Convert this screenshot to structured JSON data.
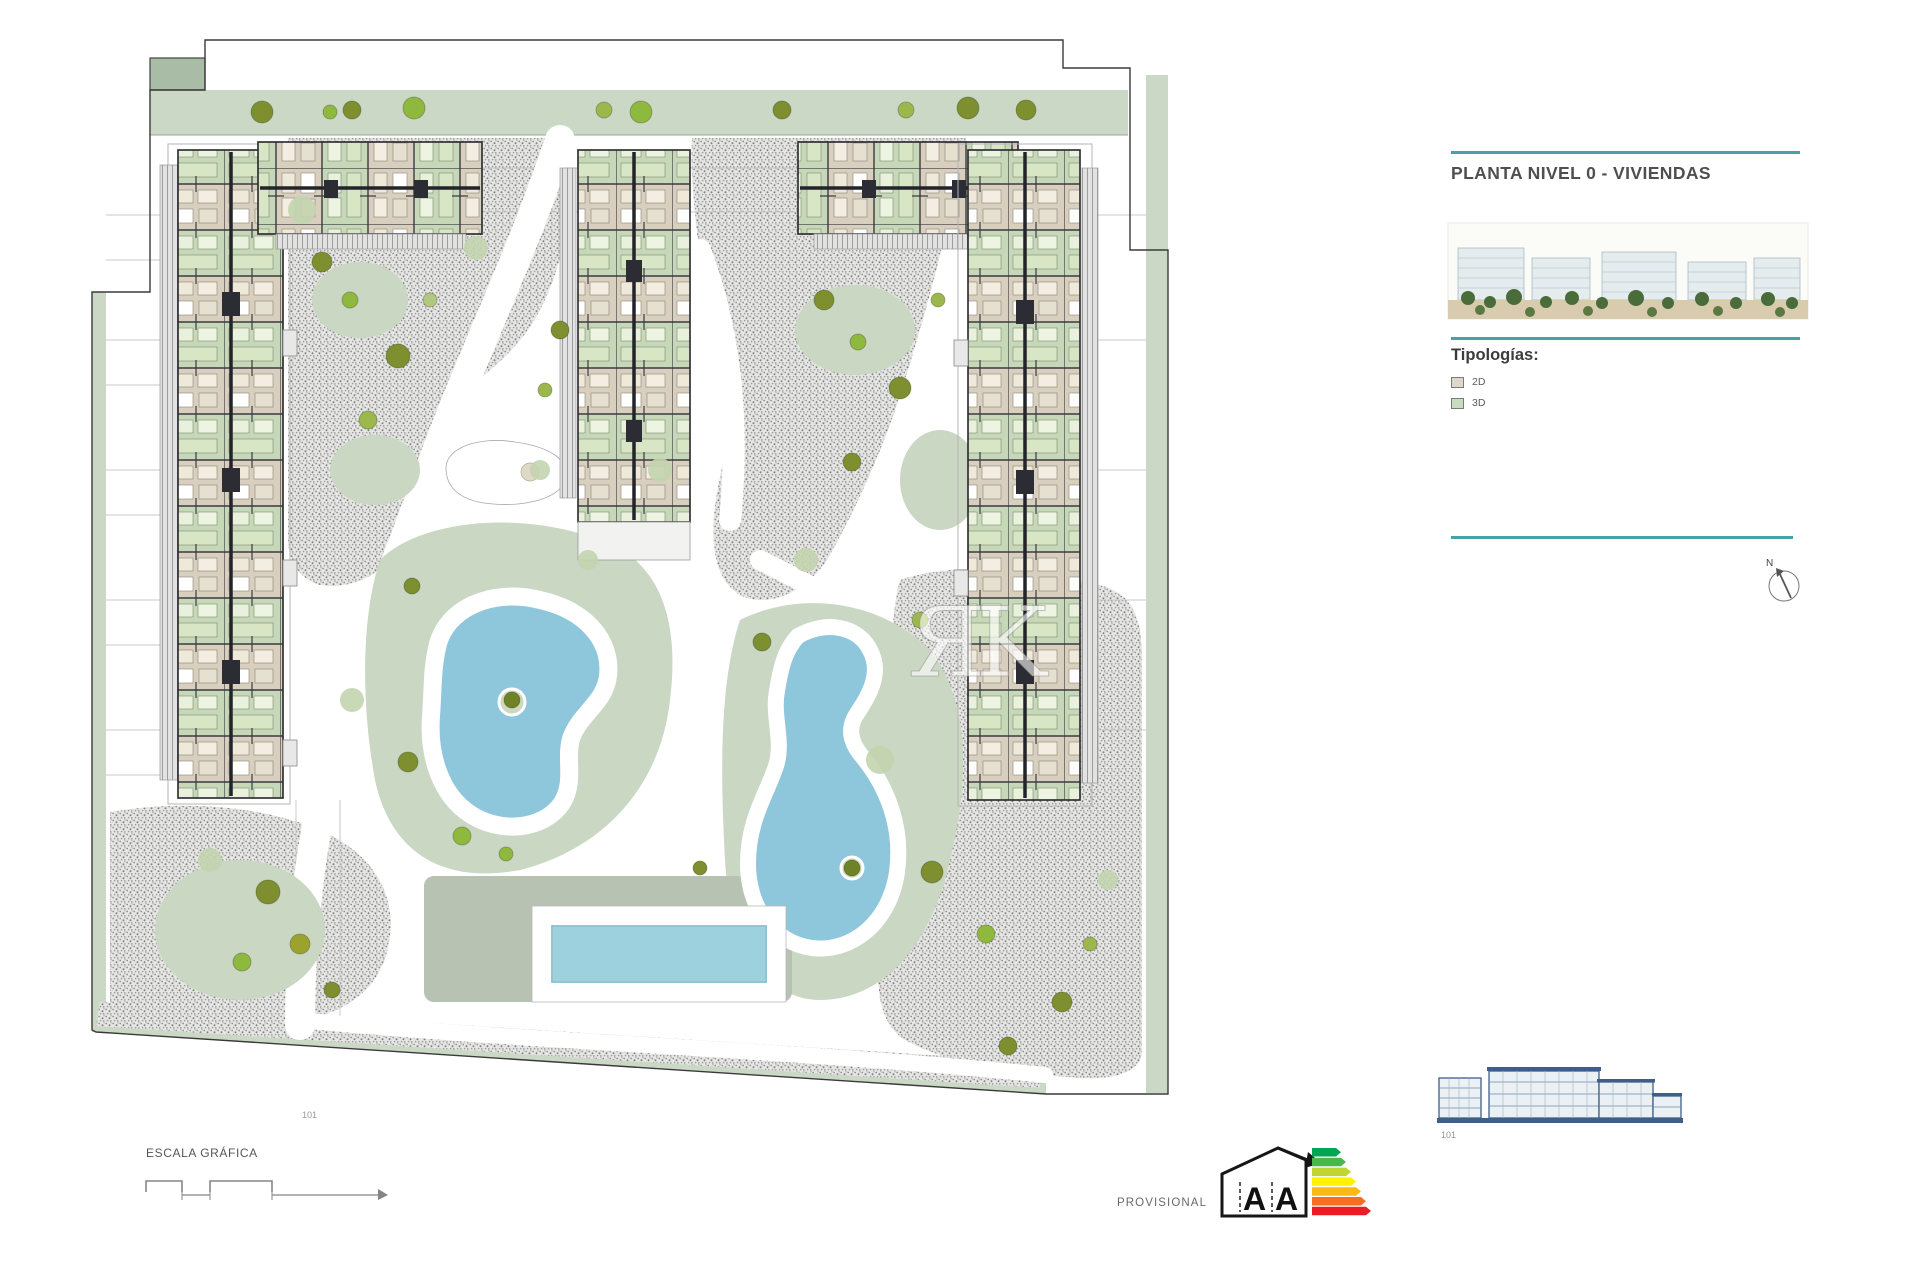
{
  "panel": {
    "accent_color": "#49a1a8",
    "title": "PLANTA NIVEL 0 - VIVIENDAS",
    "typologies_heading": "Tipologías:",
    "legend": [
      {
        "label": "2D",
        "color": "#ded7c9"
      },
      {
        "label": "3D",
        "color": "#c9dcc0"
      }
    ],
    "compass_label": "N"
  },
  "plan": {
    "watermark": "ЯK",
    "site_ref_label": "101",
    "colors": {
      "landscape_green": "#cbd8c5",
      "gravel_grey": "#a9a9a9",
      "pool_blue": "#8ec6dc",
      "unit_tan": "#d8cfbe",
      "unit_green": "#c7d8b8"
    }
  },
  "elevation": {
    "ref_label": "101"
  },
  "footer": {
    "scale_label": "ESCALA GRÁFICA",
    "provisional_label": "PROVISIONAL",
    "energy": {
      "letters": [
        "A",
        "A"
      ],
      "colors": [
        "#00a650",
        "#4cb748",
        "#bed62f",
        "#fef200",
        "#fdb813",
        "#f36f21",
        "#ec1c24"
      ]
    }
  }
}
